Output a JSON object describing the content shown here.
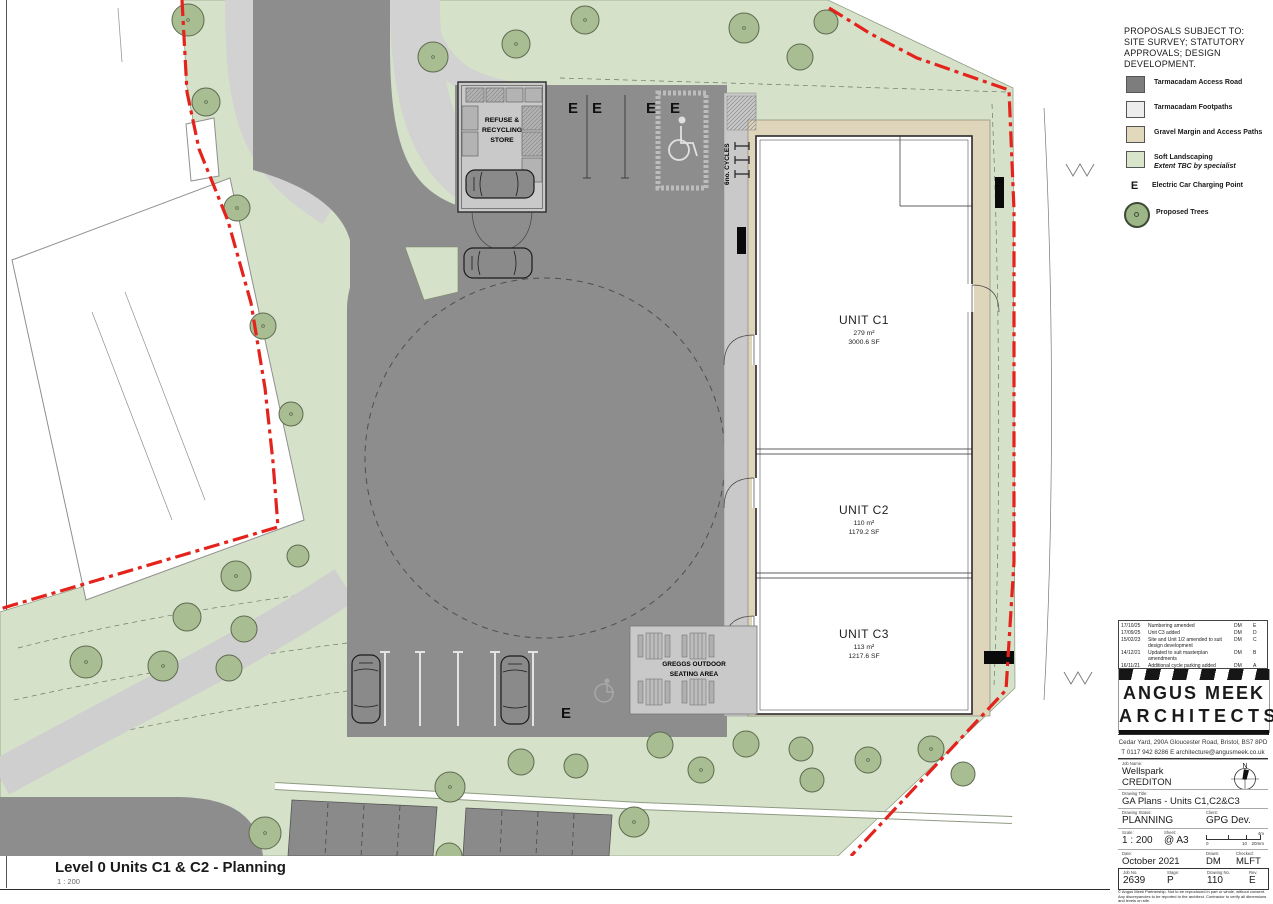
{
  "colors": {
    "boundary_red": "#e3231c",
    "road_gray": "#8d8d8d",
    "footpath_gray": "#d2d2d2",
    "gravel_tan": "#ded5ba",
    "landscaping_green": "#d5e1c8",
    "tree_green": "#a9bd92"
  },
  "notes": "PROPOSALS SUBJECT TO:\nSITE SURVEY; STATUTORY\nAPPROVALS; DESIGN\nDEVELOPMENT.",
  "legend": {
    "items": [
      {
        "label": "Tarmacadam Access Road"
      },
      {
        "label": "Tarmacadam Footpaths"
      },
      {
        "label": "Gravel Margin and Access Paths"
      },
      {
        "label": "Soft Landscaping",
        "sublabel": "Extent TBC by specialist"
      },
      {
        "symbol": "E",
        "label": "Electric Car Charging Point"
      },
      {
        "label": "Proposed Trees"
      }
    ]
  },
  "plan": {
    "ev_label": "E",
    "cycles_label": "6no. CYCLES",
    "refuse_lines": [
      "REFUSE &",
      "RECYCLING",
      "STORE"
    ],
    "greggs_lines": [
      "GREGGS OUTDOOR",
      "SEATING AREA"
    ],
    "units": [
      {
        "name": "UNIT C1",
        "area_m2": "279 m²",
        "area_sf": "3000.6 SF"
      },
      {
        "name": "UNIT C2",
        "area_m2": "110 m²",
        "area_sf": "1179.2 SF"
      },
      {
        "name": "UNIT C3",
        "area_m2": "113 m²",
        "area_sf": "1217.6 SF"
      }
    ]
  },
  "revisions": {
    "header": {
      "date": "Date",
      "desc": "Description",
      "drawn": "Drawn",
      "rev": "Rev."
    },
    "rows": [
      {
        "date": "17/10/25",
        "desc": "Numbering amended",
        "drawn": "DM",
        "rev": "E"
      },
      {
        "date": "17/09/25",
        "desc": "Unit C3 added",
        "drawn": "DM",
        "rev": "D"
      },
      {
        "date": "15/02/23",
        "desc": "Site and Unit 1/2 amended to suit design development",
        "drawn": "DM",
        "rev": "C"
      },
      {
        "date": "14/12/21",
        "desc": "Updated to suit masterplan amendments",
        "drawn": "DM",
        "rev": "B"
      },
      {
        "date": "16/11/21",
        "desc": "Additional cycle parking added",
        "drawn": "DM",
        "rev": "A"
      }
    ]
  },
  "firm": {
    "name_line1": "ANGUS MEEK",
    "name_line2": "ARCHITECTS",
    "address": "Cedar Yard,  290A Gloucester Road,  Bristol,  BS7 8PD",
    "contact": "T  0117 942 8286   E   architecture@angusmeek.co.uk"
  },
  "titleblock": {
    "job_name_label": "Job Name:",
    "job_name": "Wellspark",
    "job_town": "CREDITON",
    "north_label": "N",
    "drawing_title_label": "Drawing Title:",
    "drawing_title": "GA Plans - Units C1,C2&C3",
    "status_label": "Drawing Status:",
    "status": "PLANNING",
    "client_label": "Client:",
    "client": "GPG Dev.",
    "scale_label": "Scale:",
    "scale": "1 : 200",
    "sheet_label": "Sheet:",
    "sheet": "@ A3",
    "scalebar": {
      "top_right": "4m",
      "b0": "0",
      "b1": "10",
      "b2": "20mm"
    },
    "date_label": "Date:",
    "date": "October 2021",
    "drawn_label": "Drawn:",
    "drawn": "DM",
    "checked_label": "Checked:",
    "checked": "MLFT",
    "job_no_label": "Job No.",
    "job_no": "2639",
    "stage_label": "Stage:",
    "stage": "P",
    "drawing_no_label": "Drawing No.",
    "drawing_no": "110",
    "rev_label": "Rev.",
    "rev": "E",
    "disclaimer_line1": "© Angus Meek Partnership. Not to be reproduced in part or whole, without consent.",
    "disclaimer_line2": "Any discrepancies to be reported to the architect. Contractor to verify all dimensions and levels on site."
  },
  "footer": {
    "title": "Level 0 Units C1 & C2 - Planning",
    "scale": "1 : 200"
  }
}
